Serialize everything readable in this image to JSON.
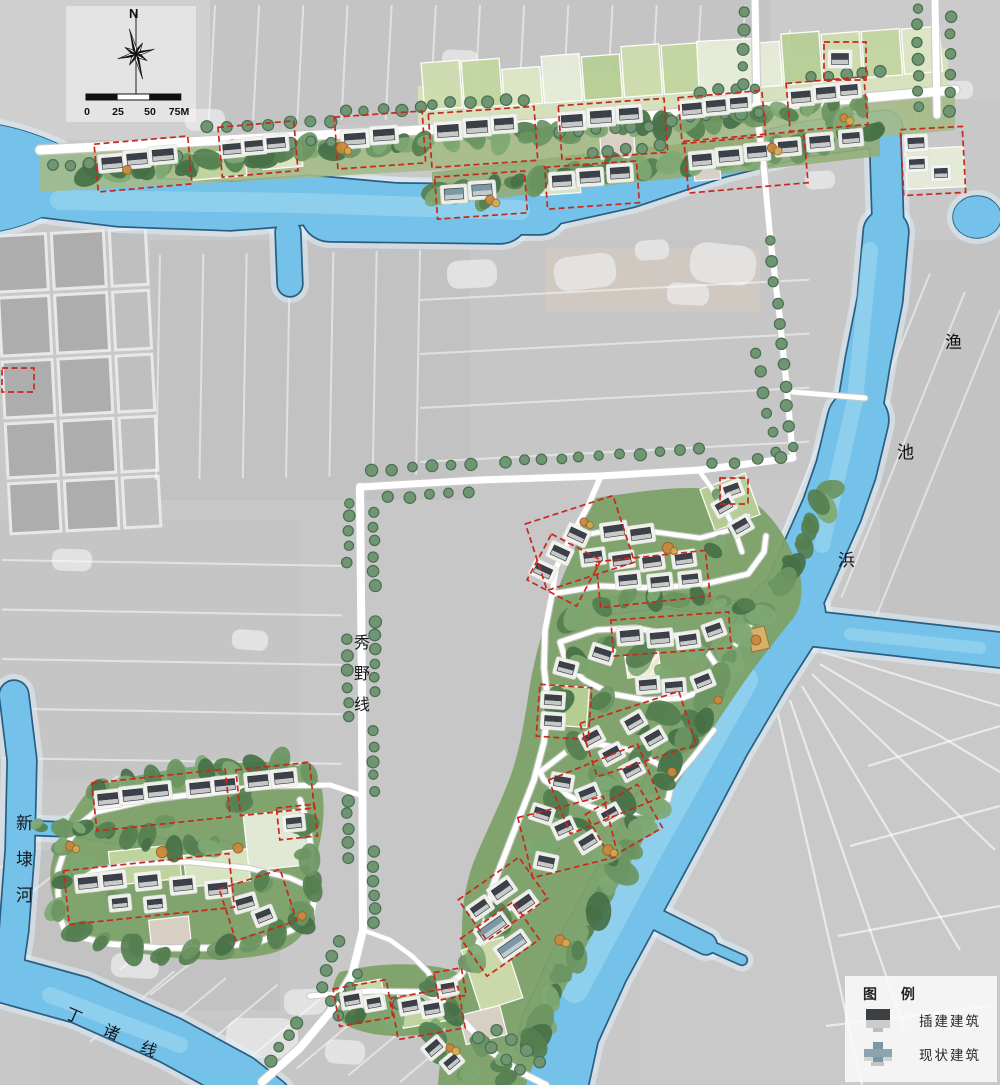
{
  "compass": {
    "north_label": "N"
  },
  "scale_bar": {
    "ticks": [
      "0",
      "25",
      "50",
      "75M"
    ]
  },
  "place_labels": {
    "river_right_chars": [
      "渔",
      "池",
      "浜"
    ],
    "road_vertical": "秀野线",
    "river_left": "新埭河",
    "river_bottom": "丁诸线"
  },
  "legend": {
    "title": "图 例",
    "items": [
      {
        "id": "infill",
        "label": "插建建筑"
      },
      {
        "id": "existing",
        "label": "现状建筑"
      }
    ]
  },
  "colors": {
    "water": "#74c2e9",
    "water_edge": "#2a5d80",
    "water_glow": "#dceff9",
    "water_light": "#a9dbf3",
    "road": "#ffffff",
    "road_casing": "#c9c9c9",
    "red_dash": "#c8281e",
    "tree": "#6f9573",
    "tree_edge": "#4a6e52",
    "veg": [
      "#557f50",
      "#477047",
      "#6b9562",
      "#7fa873"
    ],
    "field_greens": [
      "#cfdcae",
      "#c3d6a0",
      "#dde7c6",
      "#e7ecd9",
      "#b8cf96"
    ],
    "pink_parcel": "#ddd2c9",
    "village_base": "#a4ba87",
    "plot": "#f4f4f1",
    "infill_dark": "#3c4149",
    "infill_light": "#c7c9c9",
    "existing_dark": "#7b98a4",
    "existing_light": "#c2cccc",
    "accent_tree": "#c9893f"
  }
}
